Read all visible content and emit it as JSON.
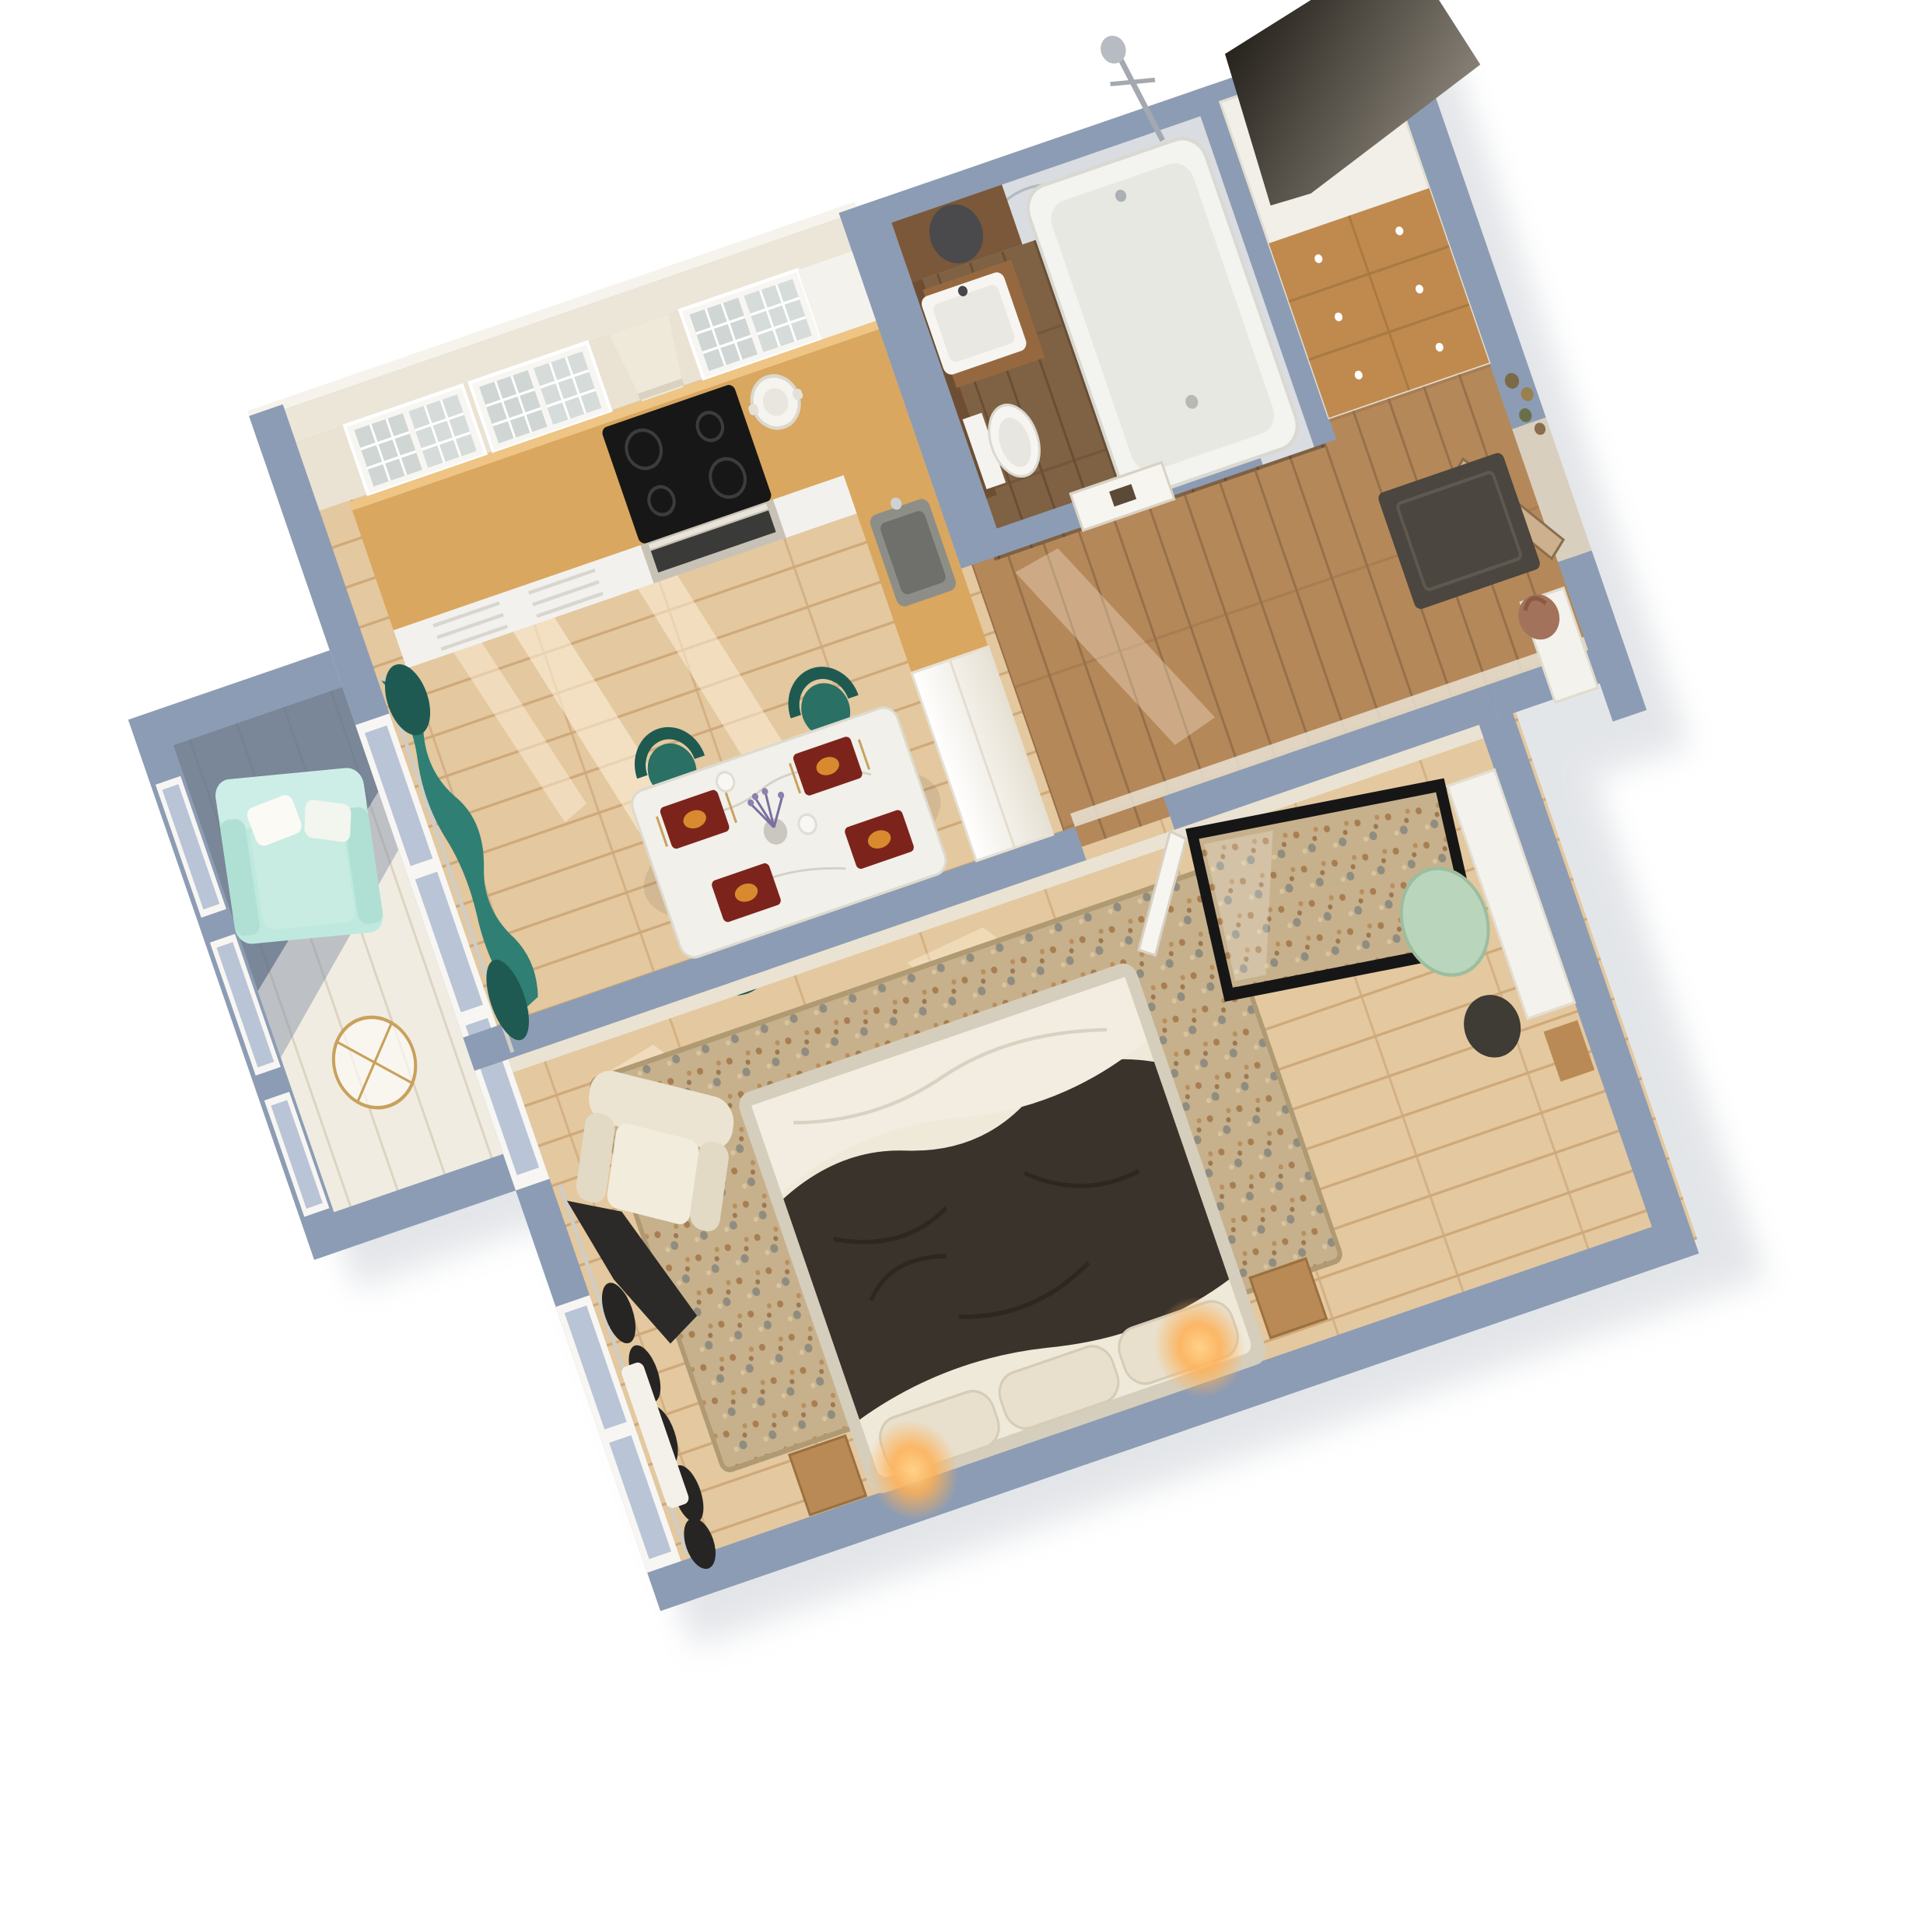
{
  "scene": {
    "kind": "3d-floor-plan-render",
    "view": "top-down axonometric, plan rotated counter-clockwise",
    "background": "#ffffff"
  },
  "palette": {
    "wall": "#8c9cb4",
    "wallShade": "#5f7088",
    "wallLight": "#9fafc4",
    "innerFace": "#eae3d3",
    "kitchenCap": "#ece6d8",
    "floorLight": "#e4c89f",
    "plankLine": "#cfa97a",
    "floorHall": "#b5885a",
    "floorBath": "#7f6143",
    "floorBalcony": "#f1ece1",
    "rugBase": "#c7b18c",
    "counterWood": "#d9a75f",
    "cooktop": "#171717",
    "cabinetWhite": "#f4f2ec",
    "glass": "#cfd6d3",
    "hood": "#efe9d9",
    "tealCurtain": "#2f7f74",
    "tealCurtainDark": "#1f5a52",
    "tealChair": "#2a7064",
    "tealChairDark": "#1f5a50",
    "placemat": "#7c241c",
    "mintSofa": "#bfe9de",
    "goldWire": "#c8a15c",
    "marble": "#d9dce0",
    "tub": "#f3f3ef",
    "vanityWood": "#96683f",
    "walnut": "#6e4e33",
    "wardrobeWood": "#c08a4f",
    "wardrobeTopDark": "#15120d",
    "doorWood": "#cdb08e",
    "doormat": "#4b463f",
    "handbag": "#a2725a",
    "duvet": "#3a332c",
    "sheet": "#f2ede0",
    "headboard": "#e8e0cd",
    "glow": "#ffb054",
    "creamChair": "#ece4d2",
    "darkCurtain": "#262524",
    "pouf": "#b9d6bd",
    "bin": "#3f3b35",
    "artFrame": "#161616",
    "nightstand": "#b98a55",
    "sun": "#fff4df"
  },
  "rooms": [
    {
      "id": "kitchen-living",
      "name": "kitchen-living-dining",
      "furniture": [
        "glass-front upper cabinets",
        "cooker hood",
        "black cooktop",
        "oven",
        "oak worktop",
        "grey sink",
        "tall white cabinet",
        "white stock pot",
        "marble dining table",
        "teal tub chairs",
        "red place settings",
        "lavender vase",
        "teal curtains",
        "sunlight patches"
      ]
    },
    {
      "id": "balcony",
      "name": "balcony",
      "furniture": [
        "mint armchair",
        "white pillows",
        "gold wire side table",
        "window frames"
      ]
    },
    {
      "id": "bathroom",
      "name": "bathroom",
      "furniture": [
        "bathtub",
        "shower mixer",
        "marble walls",
        "wood vanity with white basin",
        "wall-hung toilet",
        "walnut counter with round basin",
        "door with sign"
      ]
    },
    {
      "id": "hallway",
      "name": "hallway",
      "furniture": [
        "tall wardrobe with oak drawers",
        "dark wardrobe top",
        "entrance door",
        "dark doormat",
        "white console",
        "brown handbag",
        "dried flowers"
      ]
    },
    {
      "id": "bedroom",
      "name": "bedroom",
      "furniture": [
        "double bed",
        "charcoal duvet",
        "white sheet",
        "headboard cushions with glowing lamps",
        "oak nightstands",
        "patterned rug",
        "cream armchair",
        "black curtains",
        "window bench",
        "framed speckled mirror",
        "white desk",
        "sage pouf",
        "dark bin"
      ]
    }
  ]
}
